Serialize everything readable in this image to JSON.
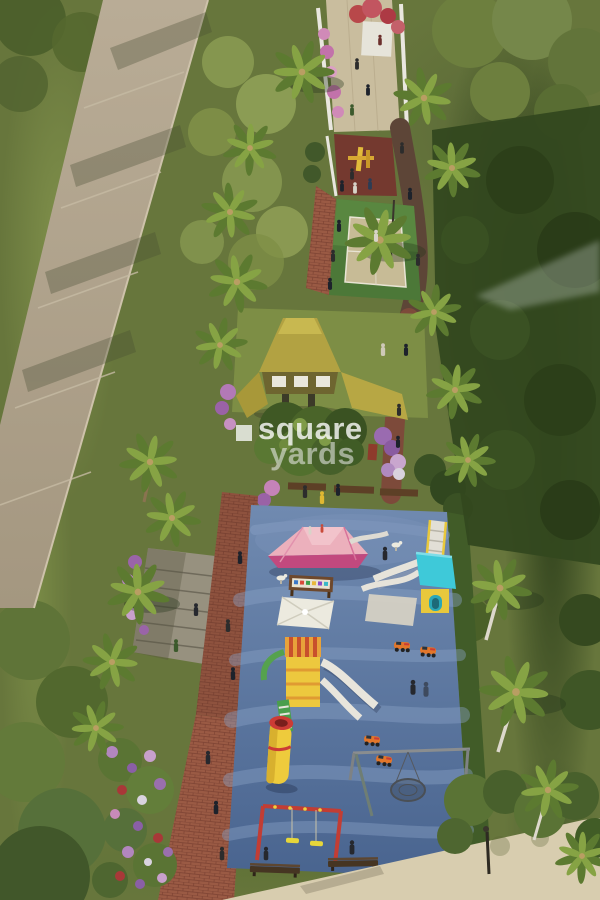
{
  "watermark": {
    "line1": "square",
    "line2": "yards",
    "icon": "square-glyph"
  },
  "scene": {
    "type": "aerial-3d-render",
    "subject": "linear landscaped park strip with entrance walkway, sports court, gazebo and children's playground, bordered by a road and dense trees",
    "elements": [
      "access-road",
      "entrance-walkway",
      "bougainvillea-flowers",
      "outdoor-gym-pad",
      "sports-court",
      "palm-trees",
      "hedge",
      "gazebo-pavilion",
      "flower-bush",
      "seating-benches",
      "playground-blue-floor",
      "pink-climbing-mound",
      "teal-slide-tower",
      "shade-canopy",
      "alphabet-board",
      "yellow-play-tower",
      "tube-slide",
      "spring-rider-cars",
      "nest-swing",
      "swing-set",
      "brick-path",
      "amphitheater-steps",
      "flower-beds",
      "street-lamp",
      "sprinkler-mist",
      "pedestrians",
      "concrete-walkway"
    ]
  },
  "palette": {
    "foliage_base": "#67763c",
    "foliage_dark": "#33481f",
    "foliage_light": "#93a355",
    "road": "#b4a790",
    "walkway": "#d8cdaf",
    "brick_path": "#9a5a44",
    "court_green": "#4c7838",
    "court_inner": "#c7bb96",
    "gazebo_roof": "#b2a242",
    "lawn": "#7d8e45",
    "playground_blue_top": "#708ab0",
    "playground_blue_bottom": "#49648f",
    "pink_mound": "#ecb0bc",
    "pink_mound_shadow": "#c2497e",
    "teal": "#3ec9d9",
    "play_yellow": "#edc83e",
    "play_orange": "#e2762a",
    "play_red": "#cc3b35",
    "slide_white": "#e8e5dc",
    "bench_wood": "#463522",
    "flower_purple": "#9a6fae",
    "flower_pink": "#c78ab8",
    "watermark_white": "#fafafa"
  }
}
